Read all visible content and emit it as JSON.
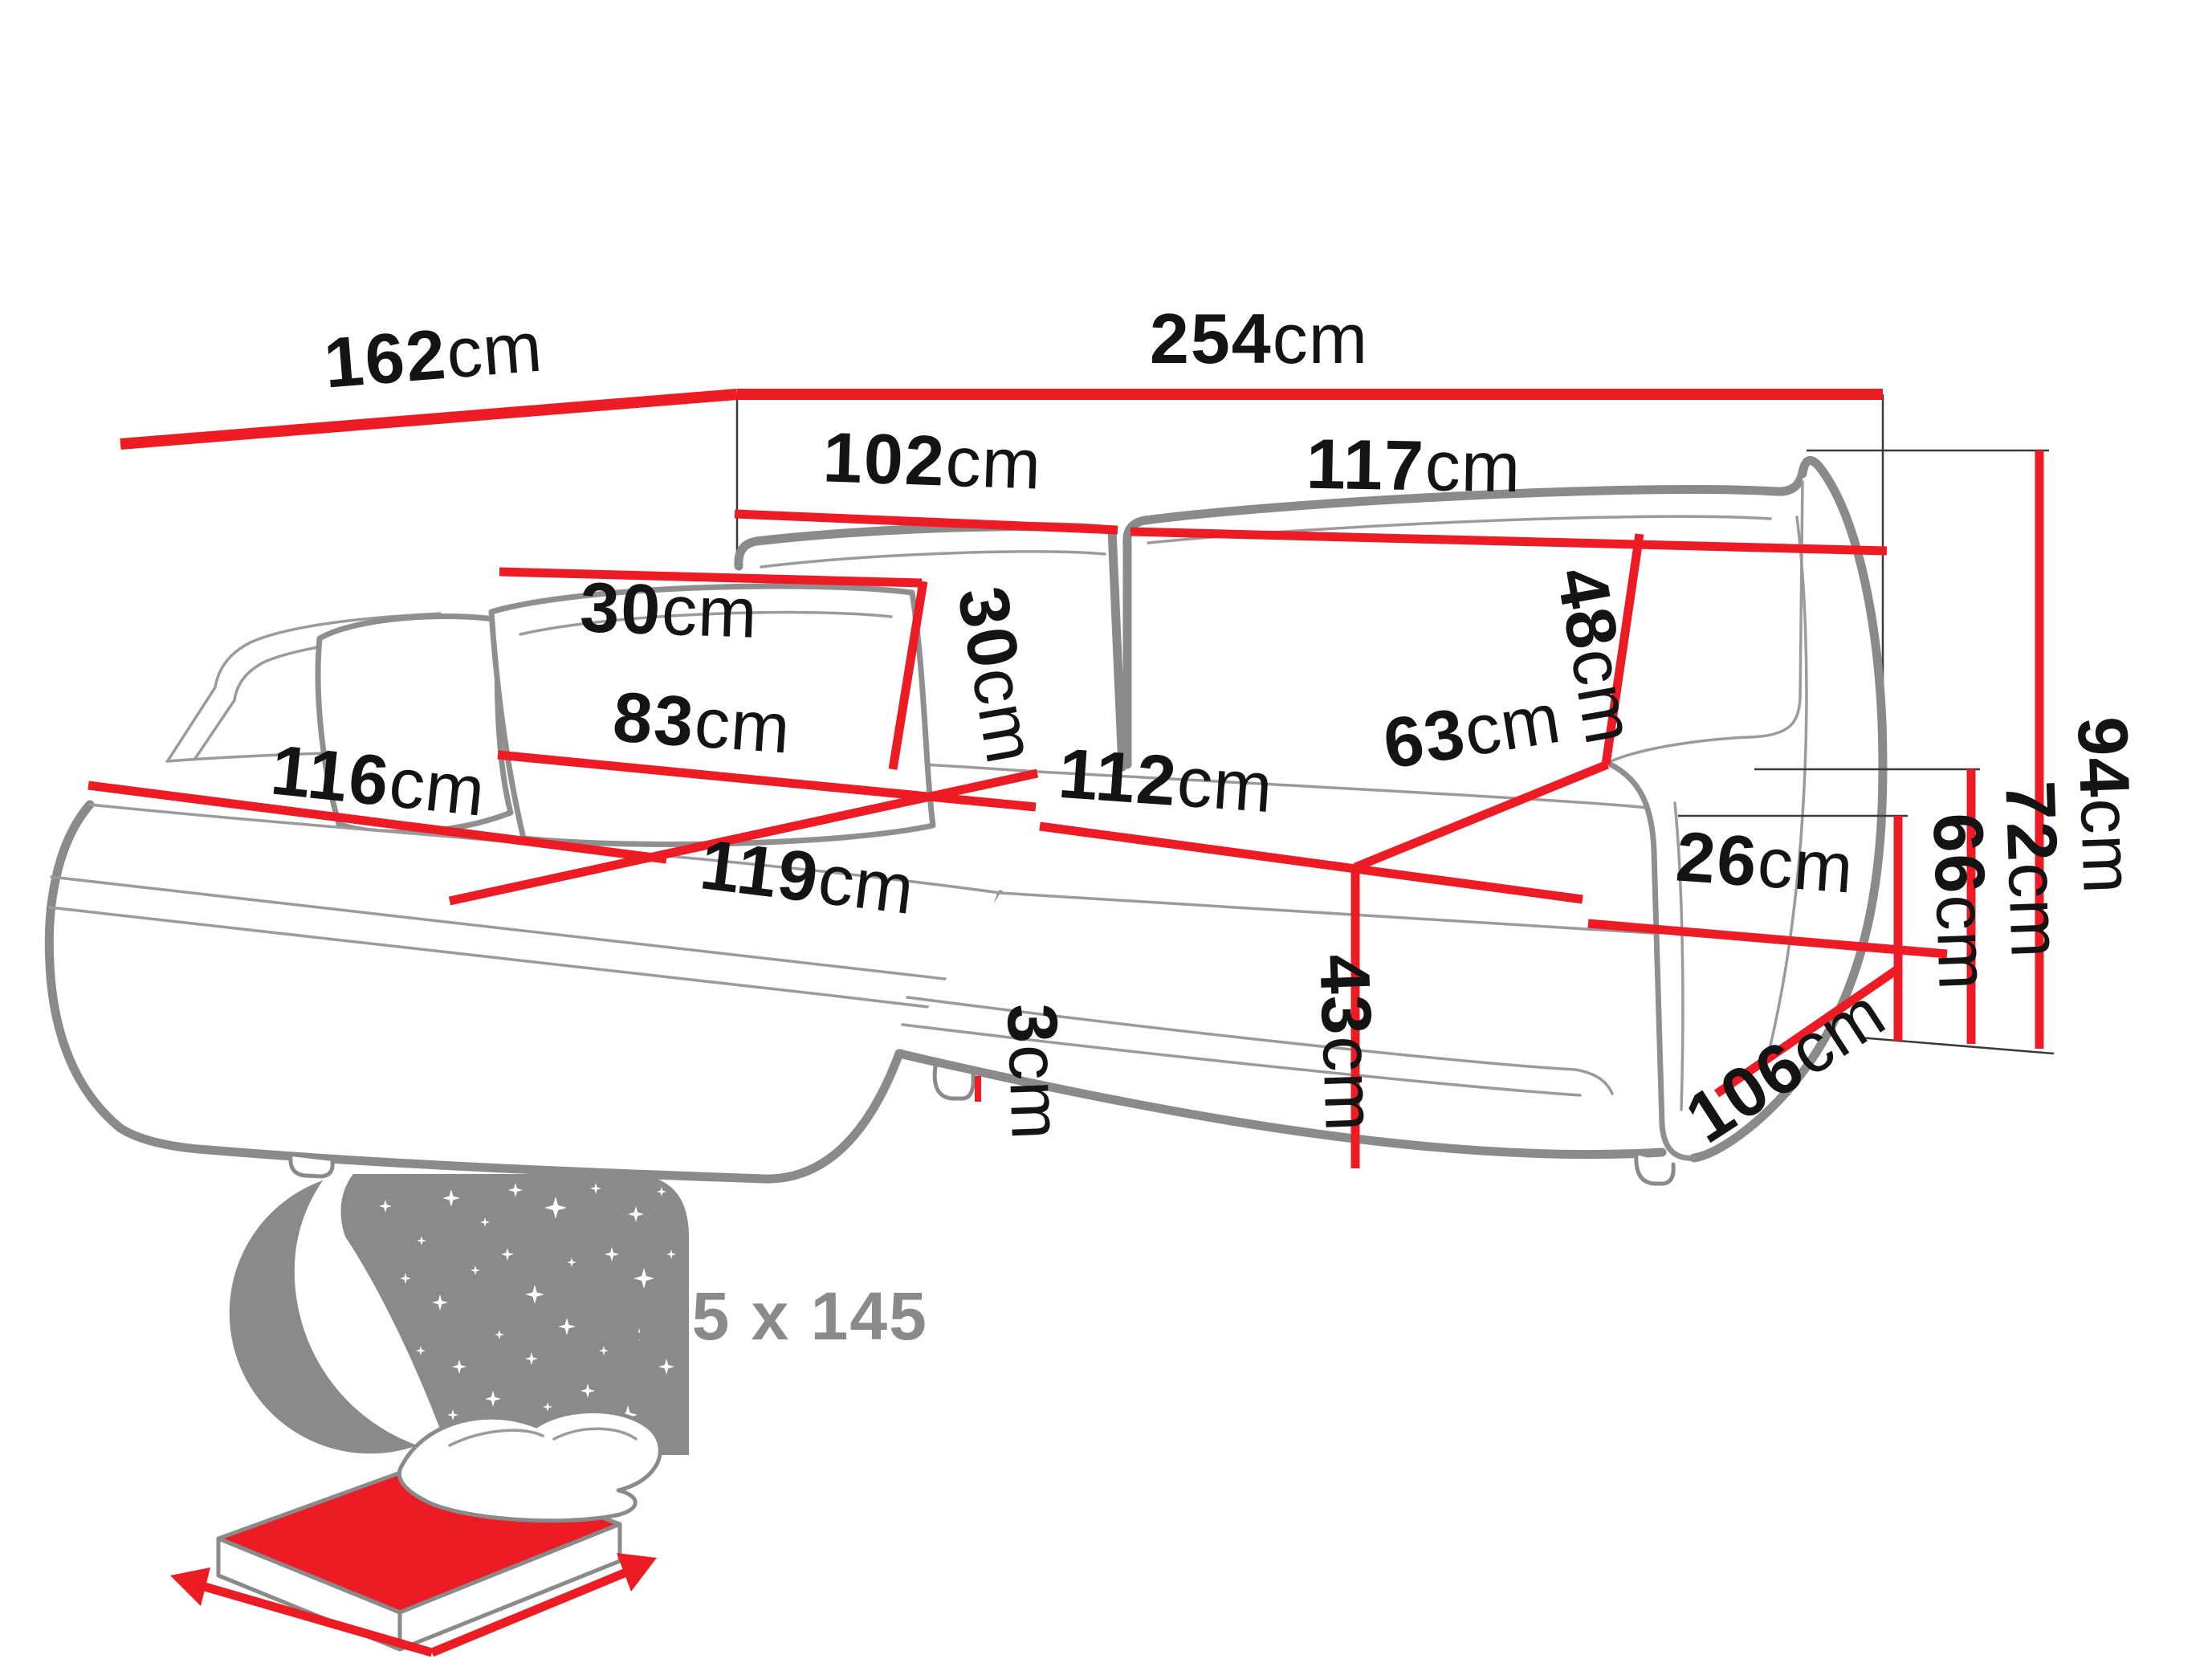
{
  "diagram": {
    "title": "corner-sofa-dimension-diagram",
    "colors": {
      "dimension_red": "#ed1c24",
      "sofa_outline_gray": "#8a8a8a",
      "label_black": "#141414",
      "icon_gray": "#8a8a8a"
    },
    "dimensions": {
      "total_width": {
        "value": "254",
        "unit": "cm"
      },
      "side_depth": {
        "value": "162",
        "unit": "cm"
      },
      "left_backrest_width": {
        "value": "102",
        "unit": "cm"
      },
      "right_backrest_width": {
        "value": "117",
        "unit": "cm"
      },
      "pillow_width": {
        "value": "30",
        "unit": "cm"
      },
      "pillow_height": {
        "value": "30",
        "unit": "cm"
      },
      "backrest_cushion_height": {
        "value": "48",
        "unit": "cm"
      },
      "chaise_seat_width": {
        "value": "83",
        "unit": "cm"
      },
      "chaise_length": {
        "value": "116",
        "unit": "cm"
      },
      "chaise_front_length": {
        "value": "119",
        "unit": "cm"
      },
      "seat_width": {
        "value": "112",
        "unit": "cm"
      },
      "seat_depth": {
        "value": "63",
        "unit": "cm"
      },
      "armrest_width": {
        "value": "26",
        "unit": "cm"
      },
      "seat_height": {
        "value": "43",
        "unit": "cm"
      },
      "leg_height": {
        "value": "3",
        "unit": "cm"
      },
      "armrest_height": {
        "value": "66",
        "unit": "cm"
      },
      "back_height": {
        "value": "72",
        "unit": "cm"
      },
      "total_height": {
        "value": "94",
        "unit": "cm"
      },
      "armrest_depth": {
        "value": "106",
        "unit": "cm"
      }
    },
    "sleeping_area": {
      "label": "195 x 145"
    }
  }
}
